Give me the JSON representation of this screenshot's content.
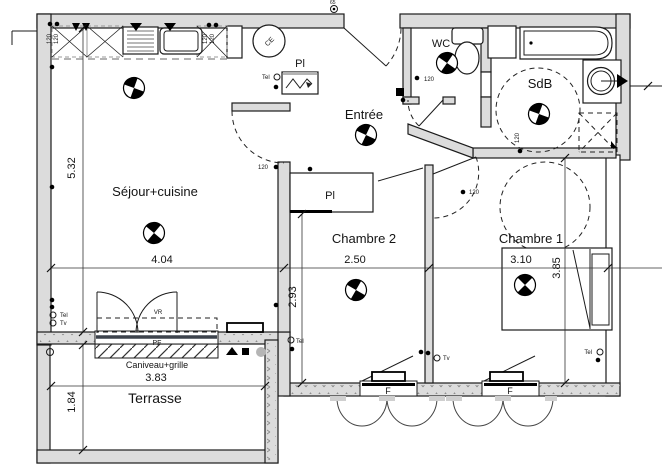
{
  "plan_type": "floor-plan",
  "rooms": {
    "living": "Séjour+cuisine",
    "entry": "Entrée",
    "bedroom2": "Chambre 2",
    "bedroom1": "Chambre 1",
    "wc": "WC",
    "bathroom": "SdB",
    "terrace": "Terrasse",
    "closet_entry": "Pl",
    "closet_bedroom2": "Pl"
  },
  "dimensions": {
    "living_height": "5.32",
    "living_width": "4.04",
    "bedroom2_width": "2.50",
    "bedroom2_height": "2.93",
    "bedroom1_width": "3.10",
    "bedroom1_height": "3.85",
    "terrace_width": "3.83",
    "terrace_height": "1.84"
  },
  "labels": {
    "roller_shutter": "VR",
    "french_window": "PF",
    "gutter": "Caniveau+grille",
    "window": "F",
    "tel": "Tel",
    "tv": "Tv",
    "water_heater": "CE",
    "h120": "120",
    "bell": "65"
  },
  "colors": {
    "wall_fill": "#dcdcdc",
    "line": "#1b1b1b",
    "overhead_dashed": "#9a9a9a"
  }
}
